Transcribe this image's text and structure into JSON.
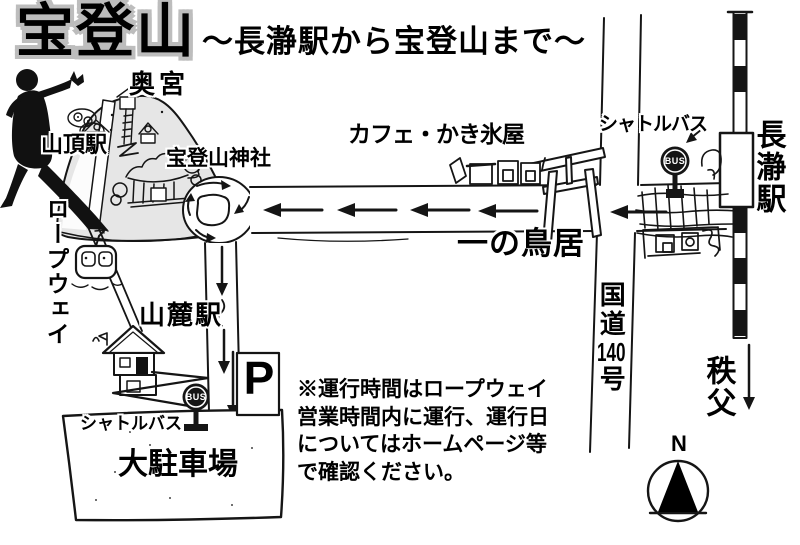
{
  "title": "宝登山",
  "subtitle": "～長瀞駅から宝登山まで～",
  "landmarks": {
    "okumiya": "奥宮",
    "summit_station": "山頂駅",
    "hodosan_shrine": "宝登山神社",
    "cafe": "カフェ・かき氷屋",
    "shuttle_bus_top": "シャトルバス",
    "first_torii": "一の鳥居",
    "nagatoro_station": "長瀞駅",
    "route140": {
      "prefix": "国道",
      "number": "140",
      "suffix": "号"
    },
    "chichibu": "秩父",
    "ropeway": "ロープウェイ",
    "base_station": "山麓駅",
    "shuttle_bus_bottom": "シャトルバス",
    "parking_lot": "大駐車場",
    "parking_symbol": "P",
    "compass_north": "N",
    "bus_badge": "BUS"
  },
  "note": {
    "lines": [
      "※運行時間はロープウェイ",
      "営業時間内に運行、運行日",
      "についてはホームページ等",
      "で確認ください。"
    ]
  },
  "colors": {
    "ink": "#151515",
    "mountain_fill": "#e6e6e6",
    "title_outline": "#bdbdbd"
  }
}
